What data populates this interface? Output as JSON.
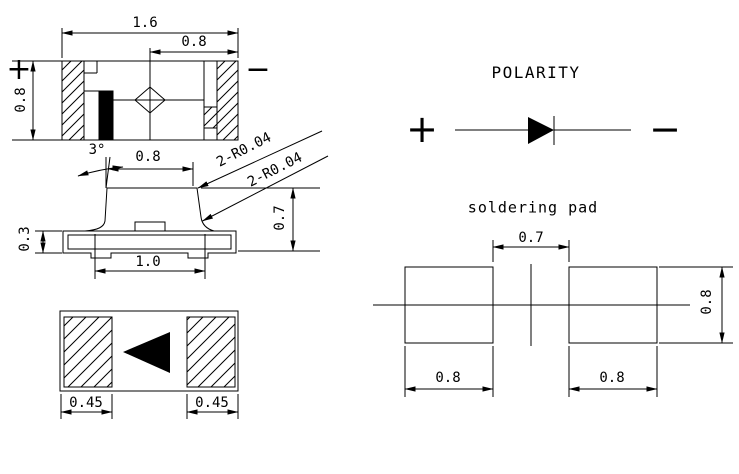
{
  "colors": {
    "ink": "#000000",
    "background": "#ffffff"
  },
  "top_view": {
    "overall_width": "1.6",
    "half_width": "0.8",
    "height": "0.8",
    "anode_mark": "+",
    "cathode_mark": "−"
  },
  "side_view": {
    "lead_angle": "3°",
    "top_width": "0.8",
    "corner_radius_note_1": "2-R0.04",
    "corner_radius_note_2": "2-R0.04",
    "body_height": "0.7",
    "base_height": "0.3",
    "bottom_width": "1.0"
  },
  "bottom_view": {
    "left_pad_width": "0.45",
    "right_pad_width": "0.45"
  },
  "polarity": {
    "title": "POLARITY",
    "anode_mark": "+",
    "cathode_mark": "−"
  },
  "soldering_pad": {
    "title": "soldering pad",
    "pad_gap": "0.7",
    "left_pad_width": "0.8",
    "right_pad_width": "0.8",
    "pad_height": "0.8"
  }
}
